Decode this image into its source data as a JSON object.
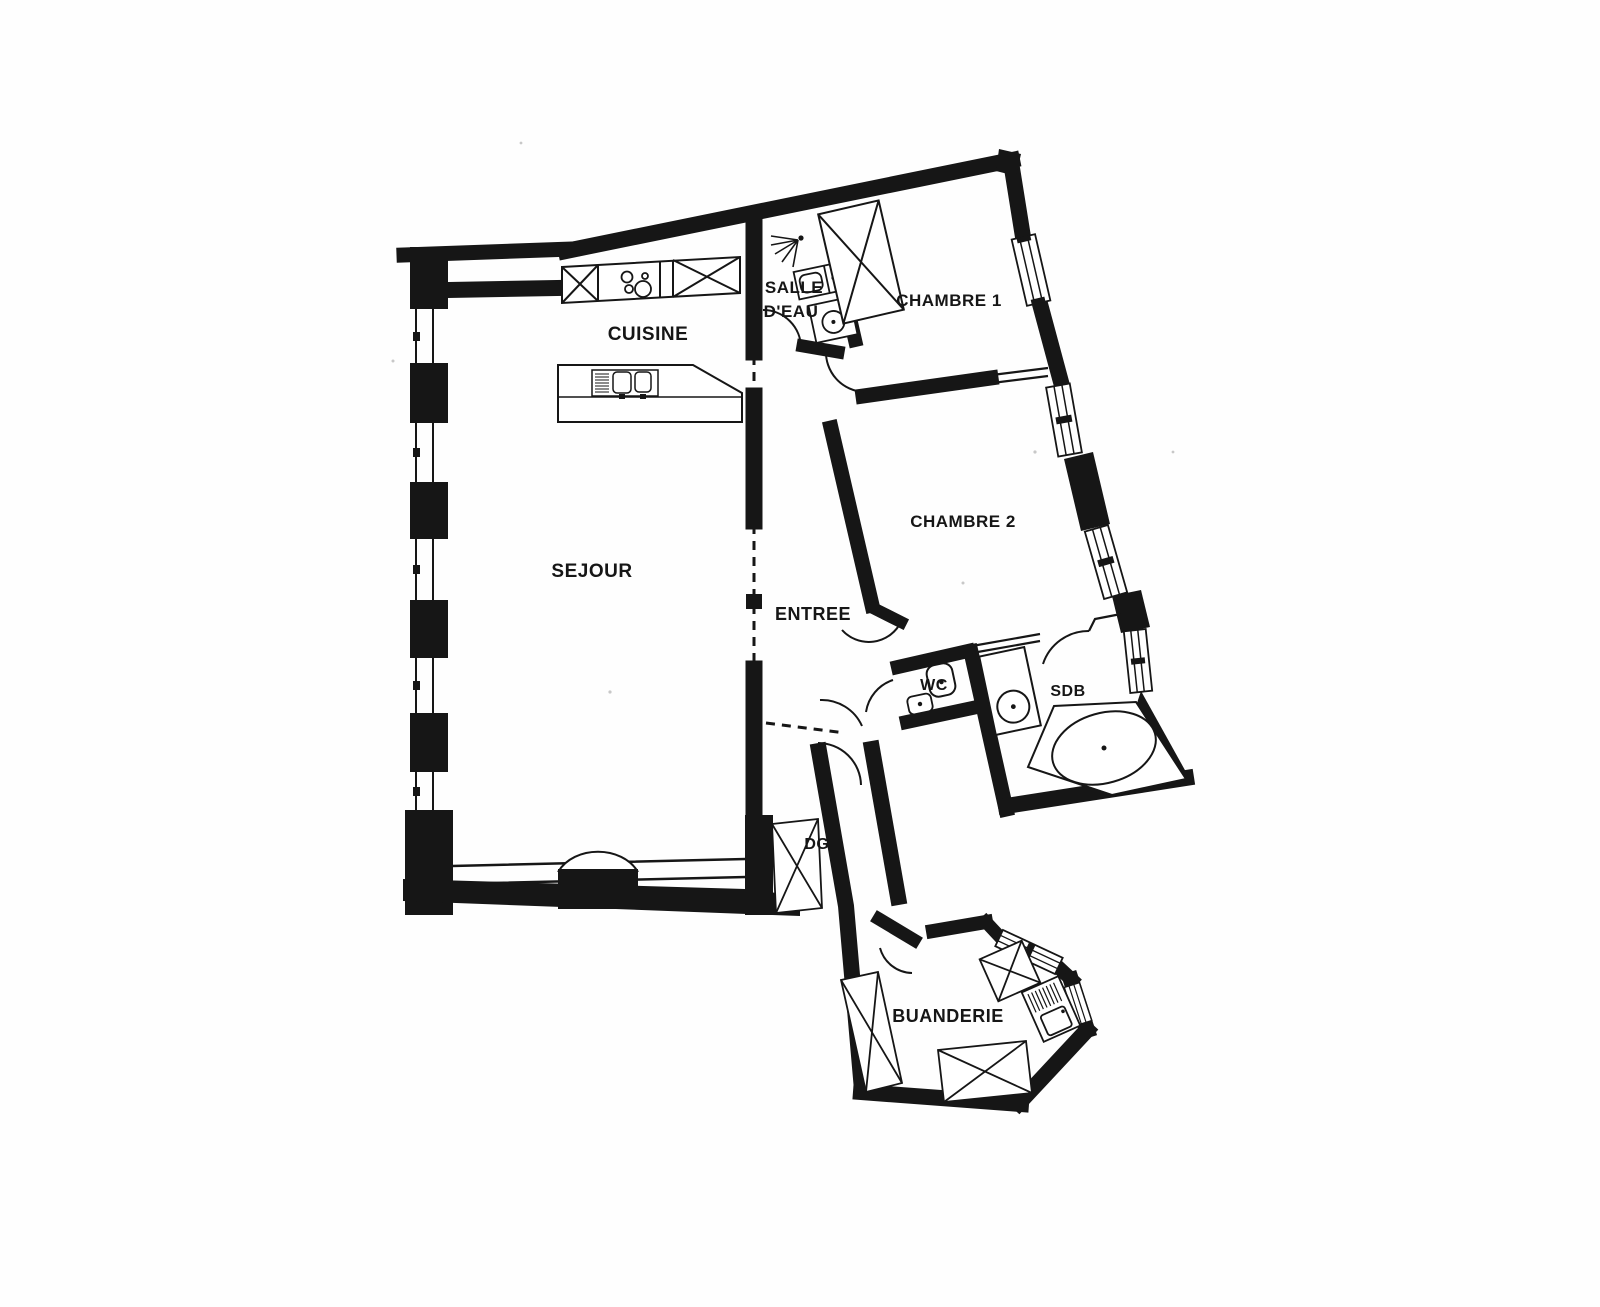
{
  "page": {
    "background": "#ffffff",
    "ink": "#161616"
  },
  "plan": {
    "type": "apartment floor plan",
    "rooms": [
      {
        "id": "cuisine",
        "label": "CUISINE"
      },
      {
        "id": "sejour",
        "label": "SEJOUR"
      },
      {
        "id": "salle_deau",
        "label": "SALLE D'EAU",
        "line1": "SALLE",
        "line2": "D'EAU"
      },
      {
        "id": "chambre1",
        "label": "CHAMBRE 1"
      },
      {
        "id": "chambre2",
        "label": "CHAMBRE 2"
      },
      {
        "id": "entree",
        "label": "ENTREE"
      },
      {
        "id": "wc",
        "label": "WC"
      },
      {
        "id": "sdb",
        "label": "SDB"
      },
      {
        "id": "dgt",
        "label": "DGT"
      },
      {
        "id": "buanderie",
        "label": "BUANDERIE"
      }
    ]
  }
}
